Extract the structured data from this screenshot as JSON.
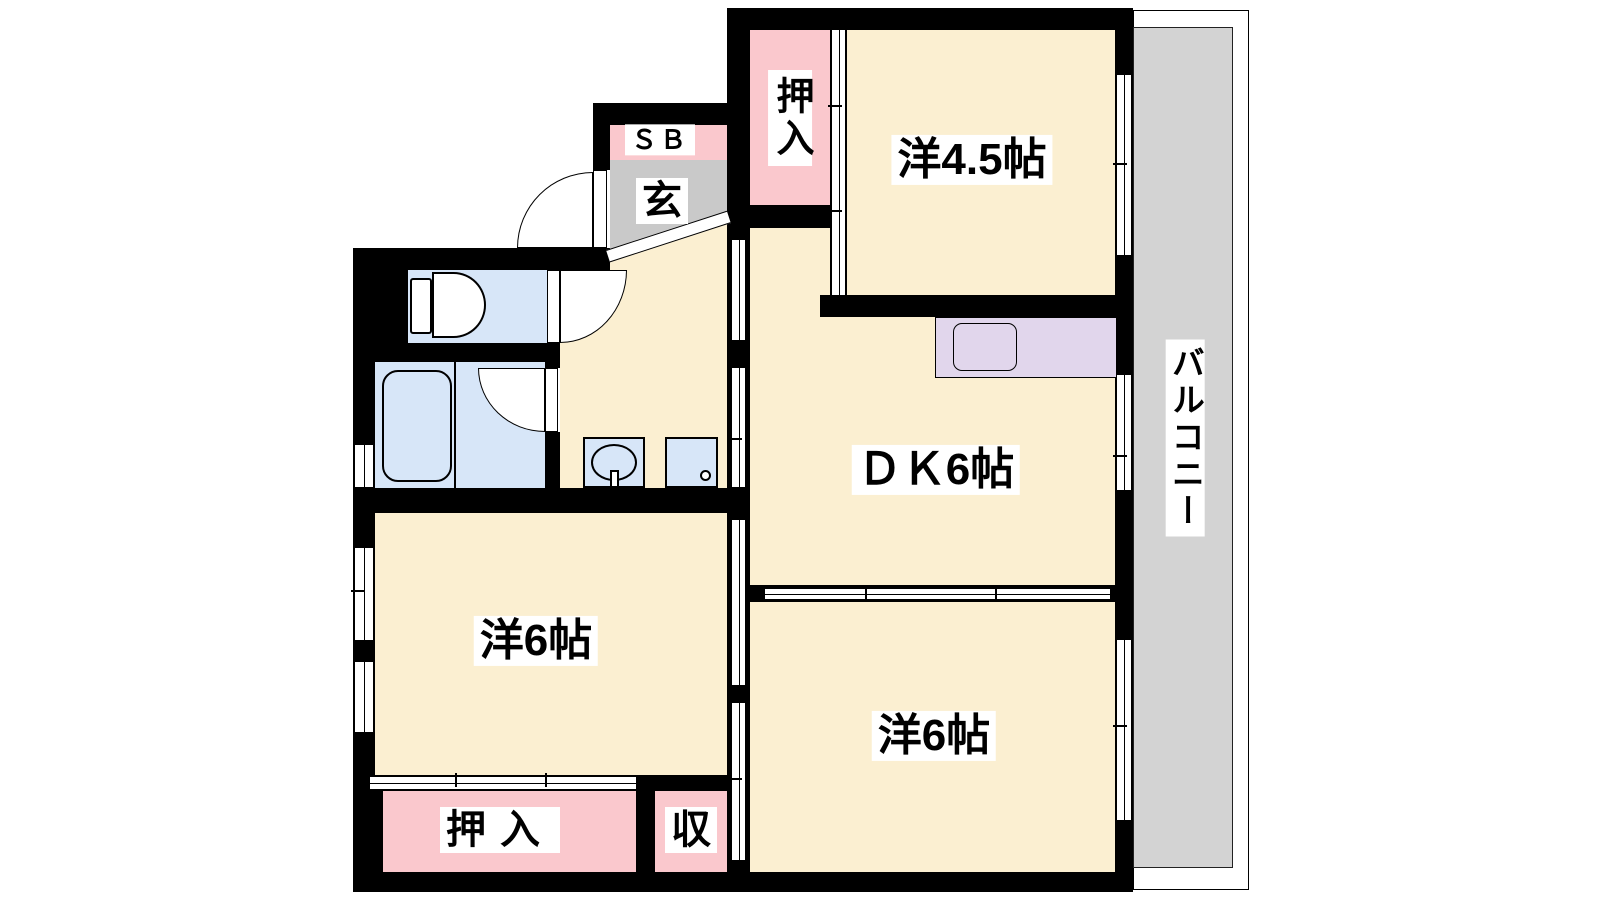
{
  "plan_type": "apartment-floor-plan",
  "colors": {
    "room_floor": "#FBEFD1",
    "closet": "#FAC8CD",
    "wet_area": "#D7E6F8",
    "entrance_floor": "#C9C9C9",
    "balcony_floor": "#D3D3D3",
    "kitchen_counter": "#E1D6EC",
    "wall": "#000000",
    "label_bg": "#FFFFFF"
  },
  "labels": {
    "western_4_5": "洋4.5帖",
    "dining_kitchen": "ＤＫ6帖",
    "western_6_left": "洋6帖",
    "western_6_right": "洋6帖",
    "closet_top": "押入",
    "closet_bottom": "押入",
    "storage": "収",
    "shoe_box": "ＳＢ",
    "entrance": "玄",
    "balcony": "バルコニー"
  },
  "fixtures": [
    "toilet-icon",
    "bathtub-icon",
    "washbasin-icon",
    "washing-machine-icon",
    "kitchen-sink-icon",
    "entrance-door-icon",
    "toilet-door-icon",
    "bathroom-door-icon"
  ]
}
